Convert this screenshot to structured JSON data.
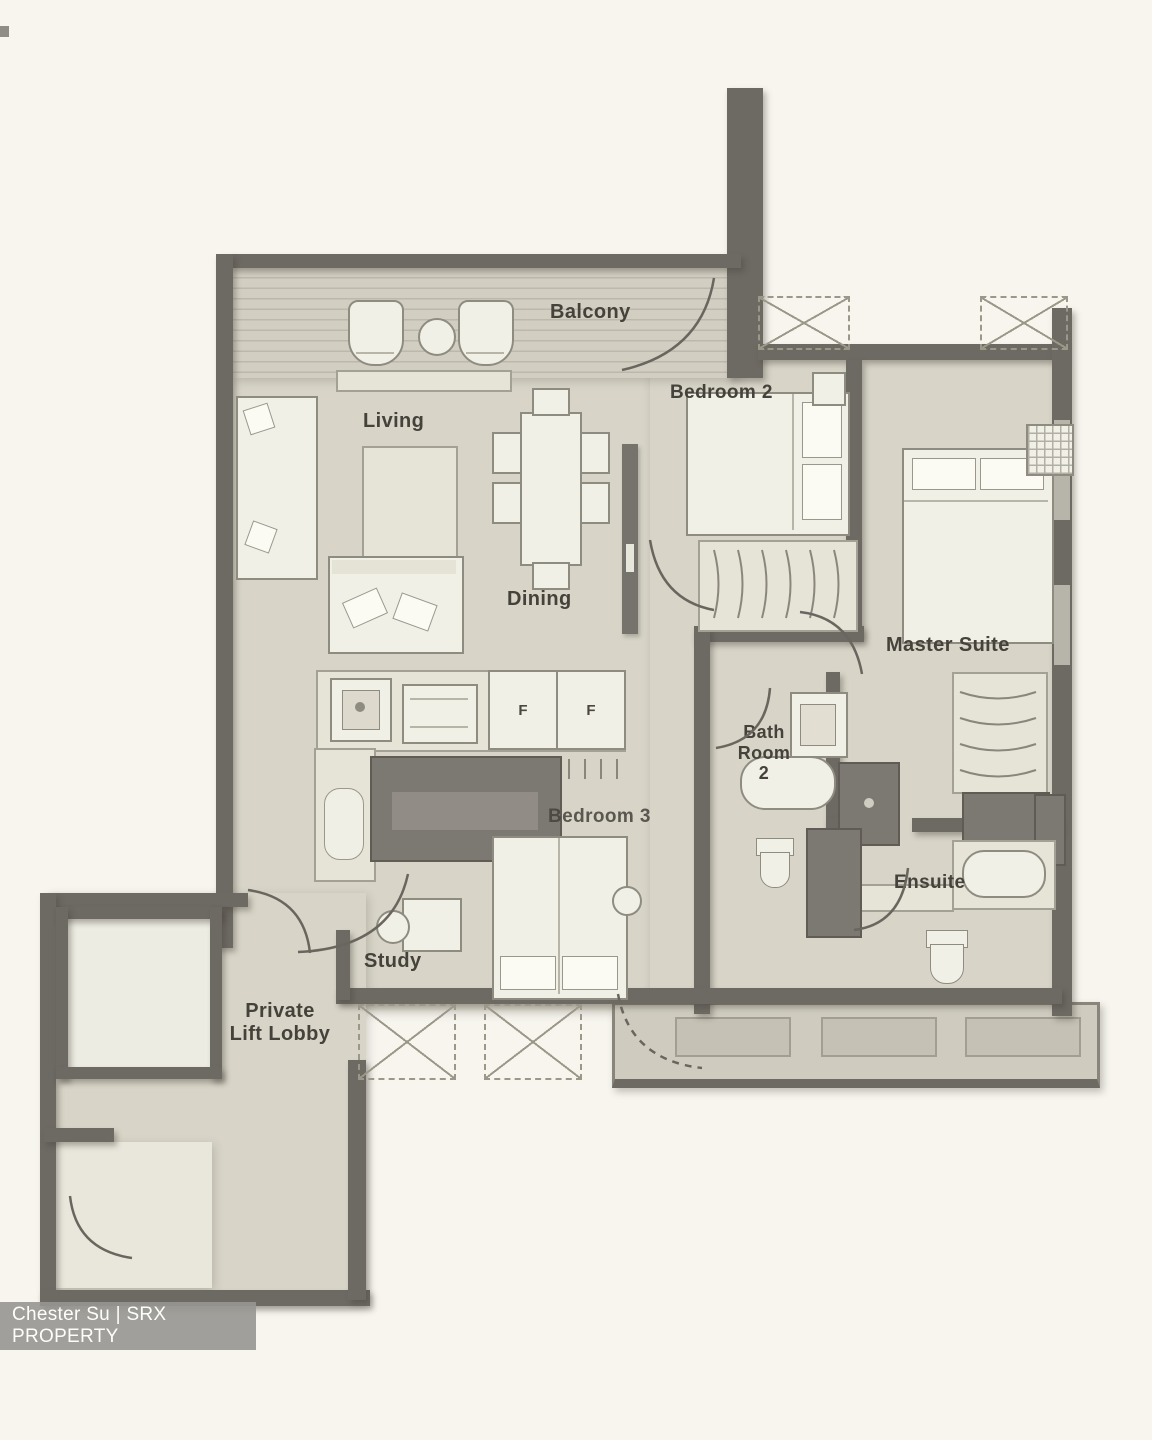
{
  "plan": {
    "rooms": {
      "balcony": "Balcony",
      "living": "Living",
      "dining": "Dining",
      "bedroom2": "Bedroom 2",
      "master_suite": "Master Suite",
      "bath_room_2": "Bath\nRoom\n2",
      "ensuite": "Ensuite",
      "bedroom3": "Bedroom 3",
      "study": "Study",
      "private_lift_lobby": "Private\nLift Lobby"
    },
    "appliances": {
      "fridge_left": "F",
      "fridge_right": "F"
    }
  },
  "watermark": {
    "text": "Chester Su | SRX PROPERTY"
  },
  "colors": {
    "background": "#f7f5ee",
    "floor": "#d8d5c8",
    "wall": "#6d6963",
    "furniture": "#f1f0e7",
    "label": "#45423c",
    "watermark_bg": "#979691",
    "watermark_text": "#fdfdfa"
  }
}
